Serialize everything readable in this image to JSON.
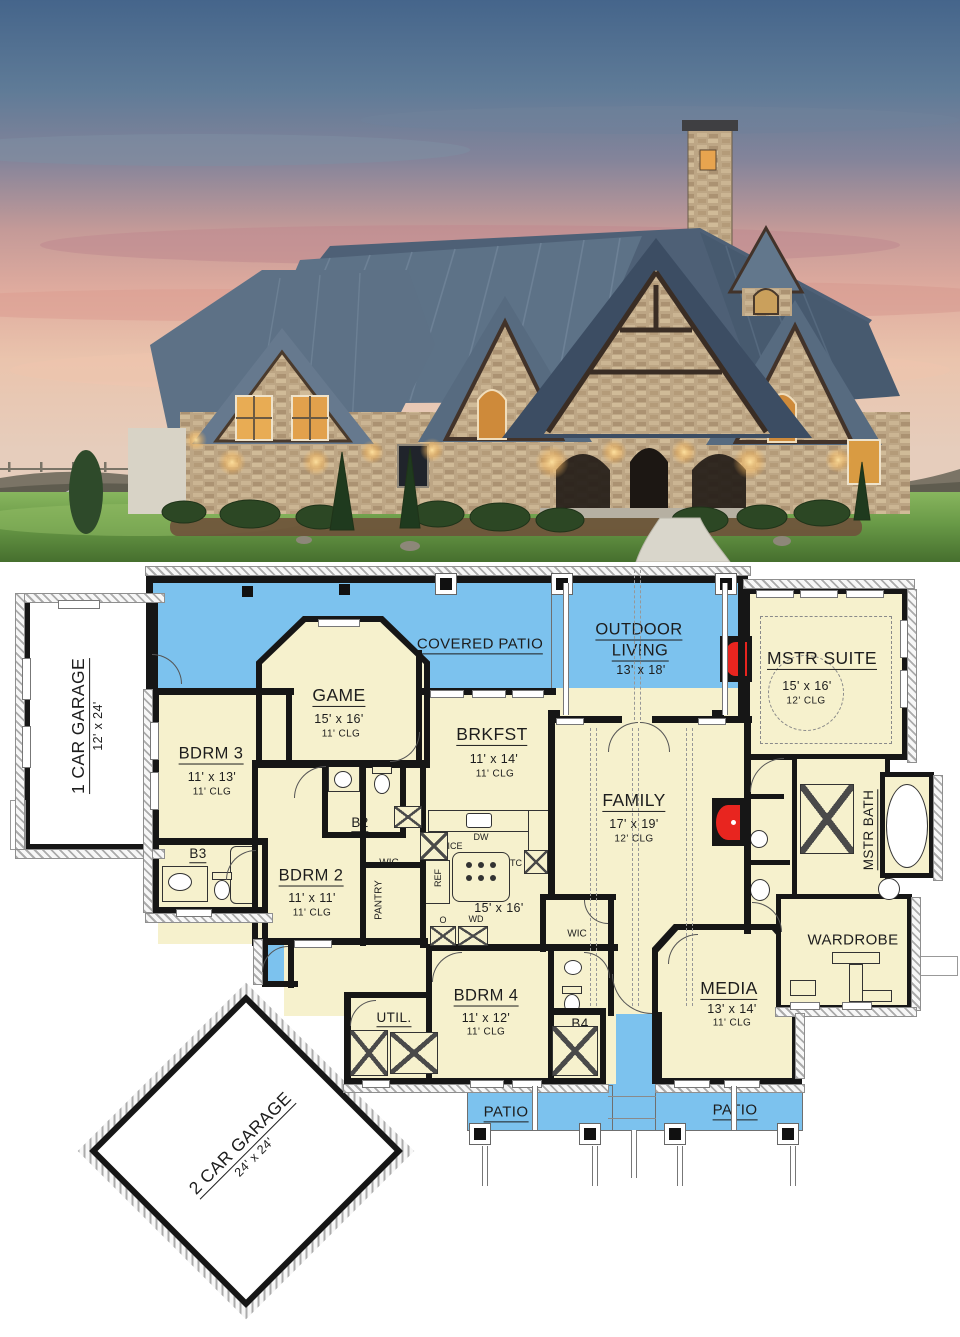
{
  "plan": {
    "colors": {
      "patio_blue": "#7CC2EE",
      "room_cream": "#F6F1CD",
      "wall": "#161616",
      "fireplace_red": "#E8251F",
      "hatch_gray": "#ABABAB"
    },
    "rooms": {
      "covered_patio": {
        "name": "COVERED PATIO"
      },
      "outdoor_living": {
        "name": "OUTDOOR LIVING",
        "name_lines": [
          "OUTDOOR",
          "LIVING"
        ],
        "dim": "13' x 18'"
      },
      "mstr_suite": {
        "name": "MSTR SUITE",
        "dim": "15' x 16'",
        "clg": "12' CLG"
      },
      "game": {
        "name": "GAME",
        "dim": "15' x 16'",
        "clg": "11' CLG"
      },
      "brkfst": {
        "name": "BRKFST",
        "dim": "11' x 14'",
        "clg": "11' CLG"
      },
      "family": {
        "name": "FAMILY",
        "dim": "17' x 19'",
        "clg": "12' CLG"
      },
      "bdrm3": {
        "name": "BDRM 3",
        "dim": "11' x 13'",
        "clg": "11' CLG"
      },
      "bdrm2": {
        "name": "BDRM 2",
        "dim": "11' x 11'",
        "clg": "11' CLG"
      },
      "bdrm4": {
        "name": "BDRM 4",
        "dim": "11' x 12'",
        "clg": "11' CLG"
      },
      "media": {
        "name": "MEDIA",
        "dim": "13' x 14'",
        "clg": "11' CLG"
      },
      "kitchen": {
        "dim": "15' x 16'"
      },
      "mstr_bath": {
        "name": "MSTR BATH"
      },
      "wardrobe": {
        "name": "WARDROBE"
      },
      "util": {
        "name": "UTIL."
      },
      "pantry": {
        "name": "PANTRY"
      },
      "b2": {
        "name": "B2"
      },
      "b3": {
        "name": "B3"
      },
      "b4": {
        "name": "B4"
      },
      "wic_hall": {
        "name": "WIC"
      },
      "wic_bdrm4": {
        "name": "WIC"
      },
      "patio_left": {
        "name": "PATIO"
      },
      "patio_right": {
        "name": "PATIO"
      },
      "garage_1": {
        "name": "1 CAR GARAGE",
        "dim": "12' x 24'"
      },
      "garage_2": {
        "name": "2 CAR GARAGE",
        "dim": "24' x 24'"
      }
    },
    "appliances": {
      "ice": "ICE",
      "ref": "REF",
      "dw": "DW",
      "tc": "TC",
      "oven": "O",
      "washer_dryer": "WD"
    }
  },
  "photo": {
    "colors": {
      "sky_top": "#45658B",
      "sunset_pink": "#D9A79D",
      "roof_slate": "#5D7287",
      "stone_tan": "#BFA987",
      "lawn_green": "#6B9C49",
      "window_glow": "#E8AC54"
    }
  }
}
